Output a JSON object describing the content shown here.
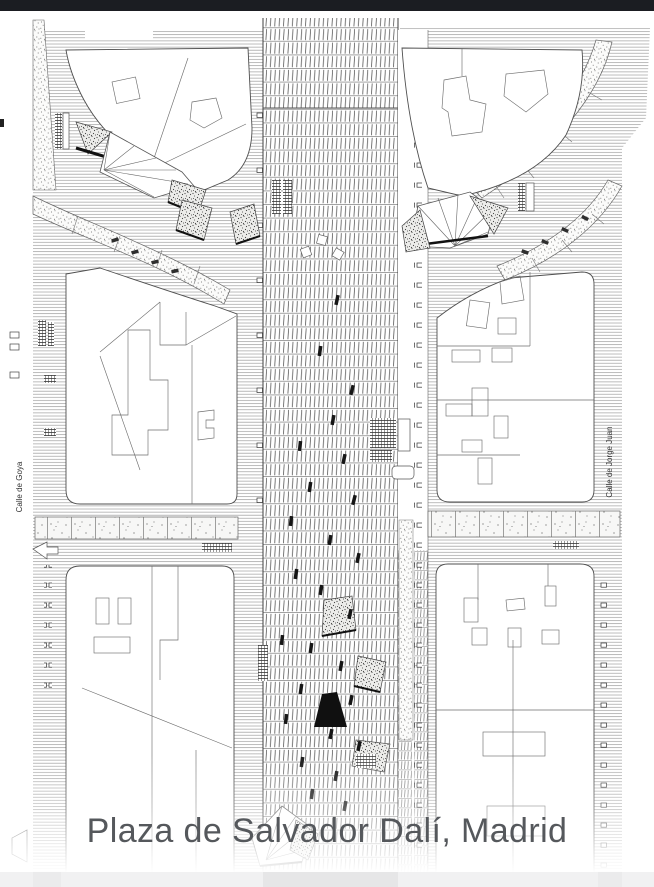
{
  "header": {
    "bar_color": "#1b1d22"
  },
  "plan": {
    "caption": "Plaza de Salvador Dalí, Madrid",
    "streets": {
      "left_label": "Calle de Goya",
      "right_label": "Calle de Jorge Juan"
    },
    "colors": {
      "page_bg": "#ffffff",
      "caption_text": "#55585c",
      "footer_band": "#f1f1f2",
      "ink": "#4a4a4a"
    }
  }
}
